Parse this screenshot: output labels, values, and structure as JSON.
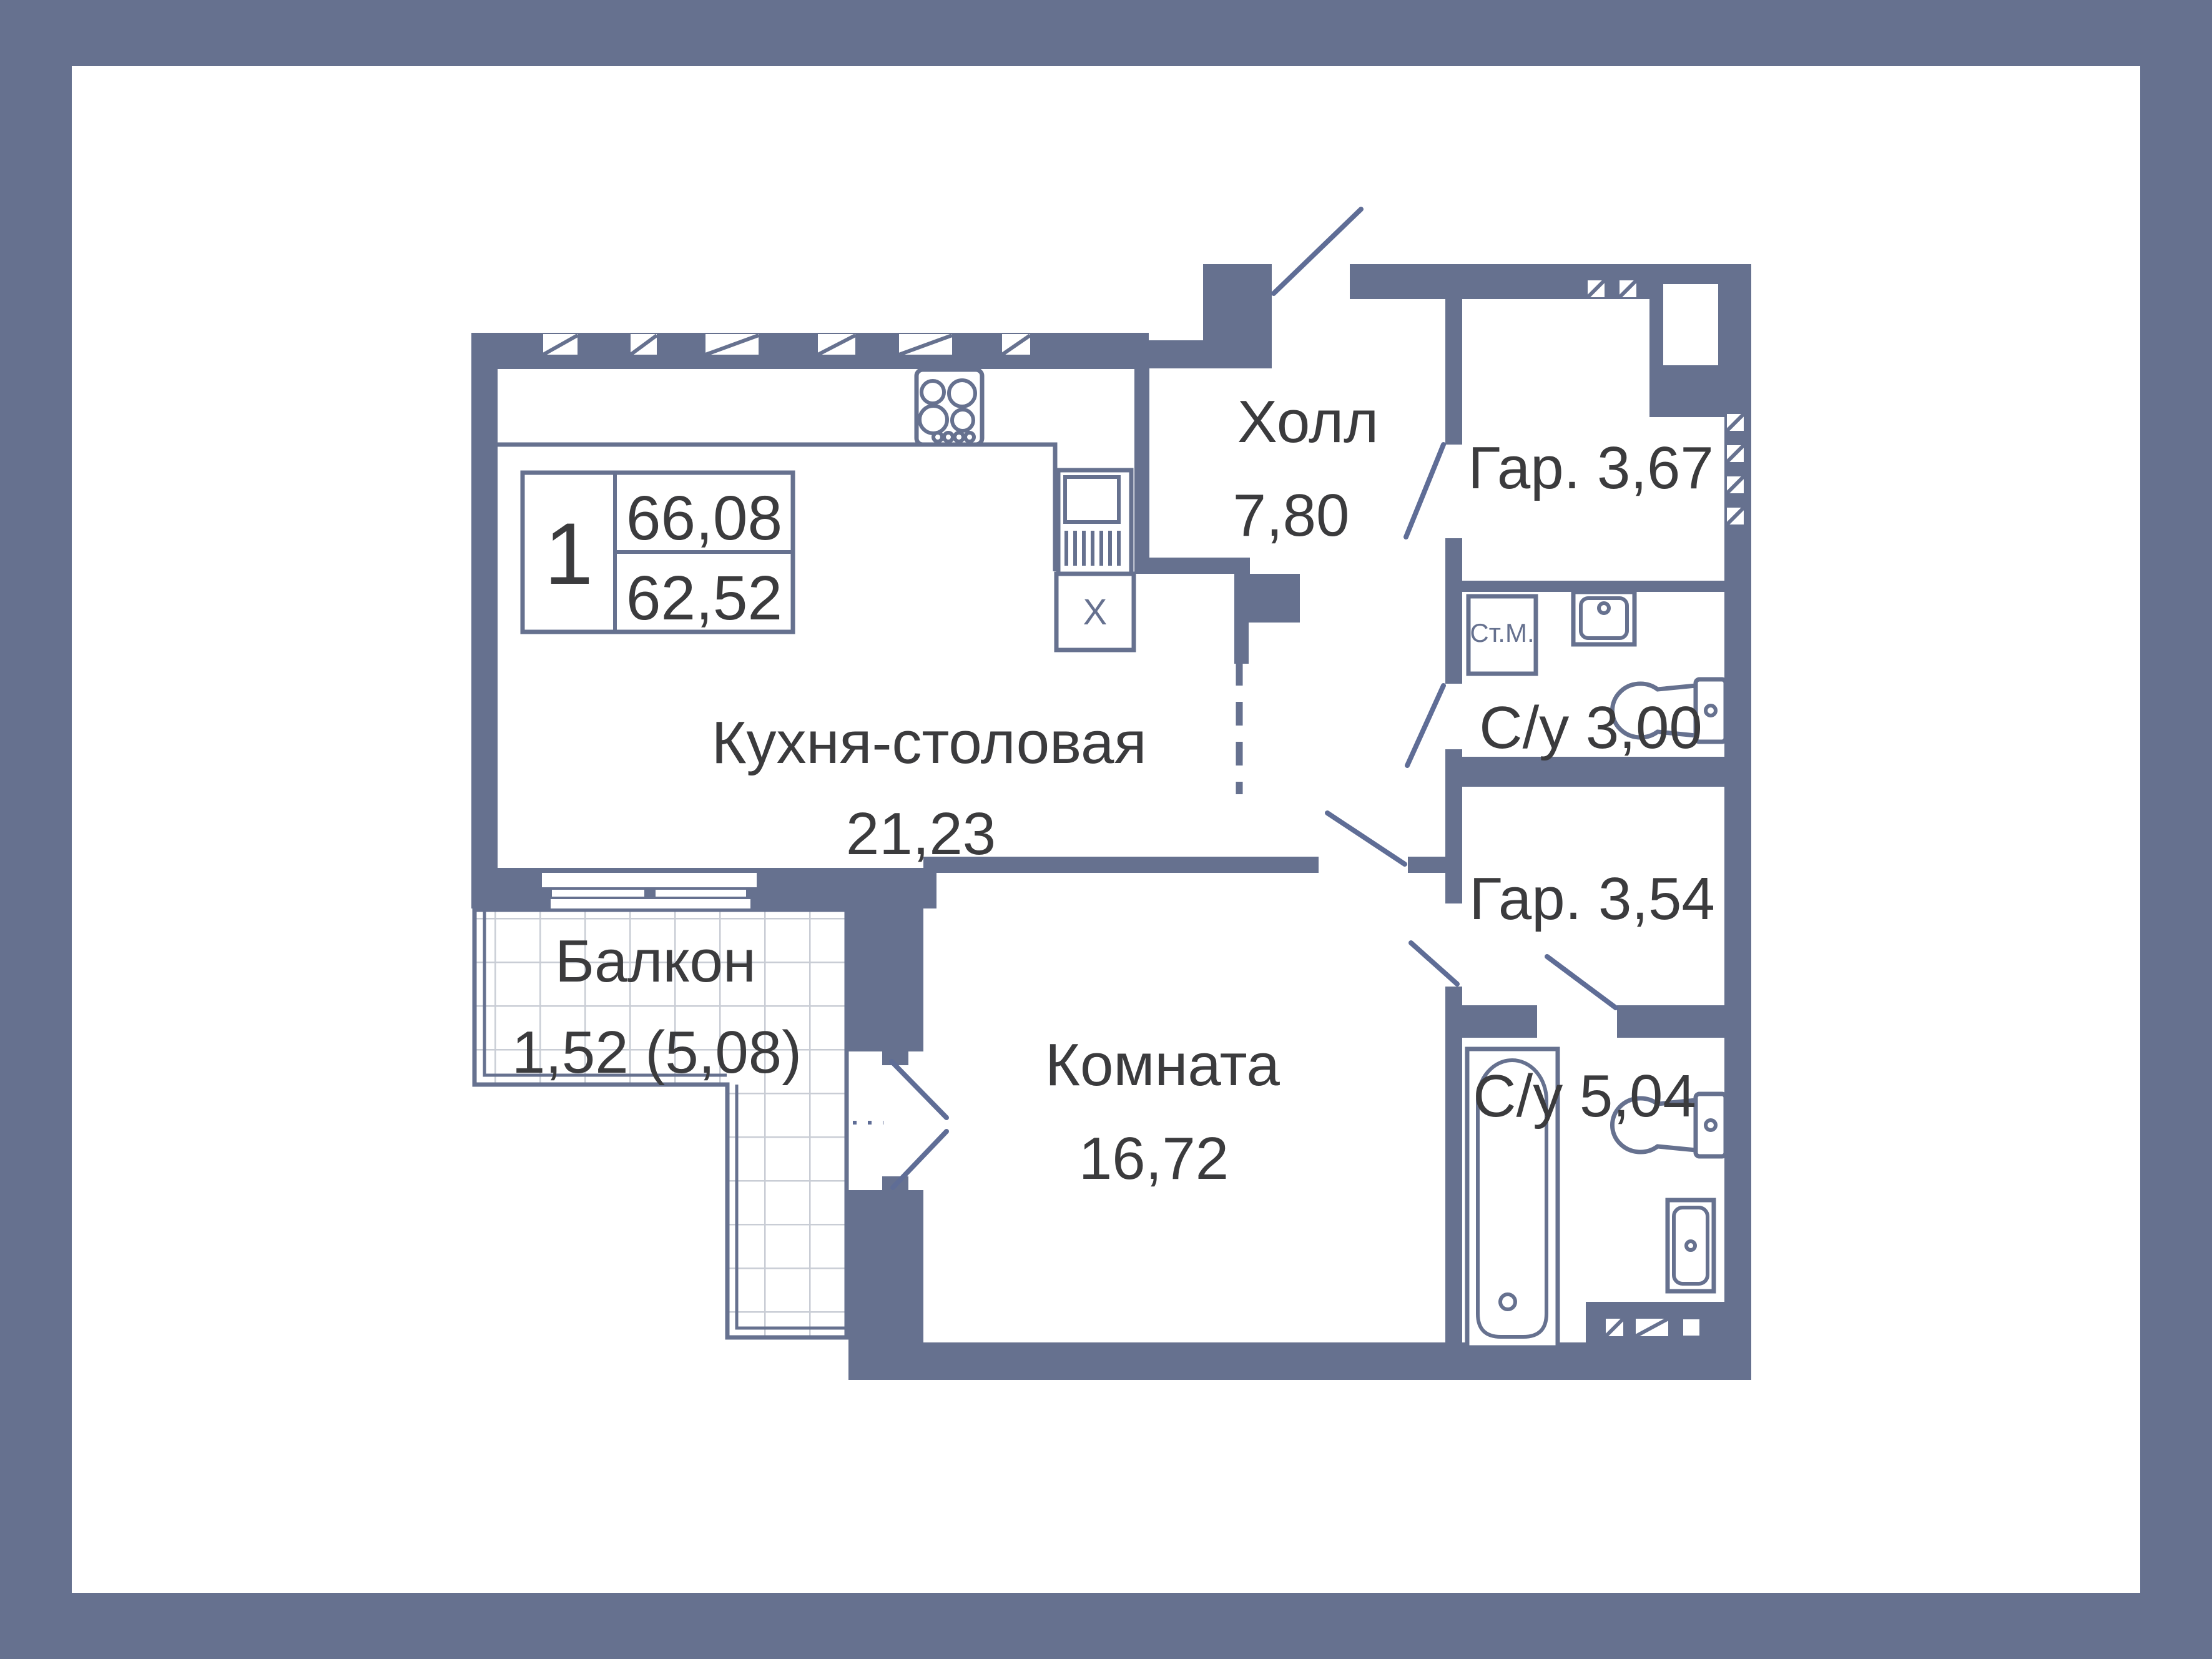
{
  "palette": {
    "wall_color": "#66718F",
    "text_color": "#3B3B3D",
    "fixture_color": "#66718F",
    "balcony_grid_color": "#C9CDD5",
    "background": "#FFFFFF"
  },
  "legend": {
    "rooms_count": "1",
    "total_area": "66,08",
    "living_area": "62,52"
  },
  "rooms": {
    "kitchen": {
      "name": "Кухня-столовая",
      "area": "21,23"
    },
    "hall": {
      "name": "Холл",
      "area": "7,80"
    },
    "wardrobe_top": {
      "label": "Гар. 3,67"
    },
    "bathroom_top": {
      "label": "С/у 3,00"
    },
    "wardrobe_low": {
      "label": "Гар. 3,54"
    },
    "bathroom_low": {
      "label": "С/у 5,04"
    },
    "living_room": {
      "name": "Комната",
      "area": "16,72"
    },
    "balcony": {
      "name": "Балкон",
      "area": "1,52 (5,08)"
    }
  },
  "markers": {
    "washing_machine": "Ст.М.",
    "appliance_x": "X"
  }
}
